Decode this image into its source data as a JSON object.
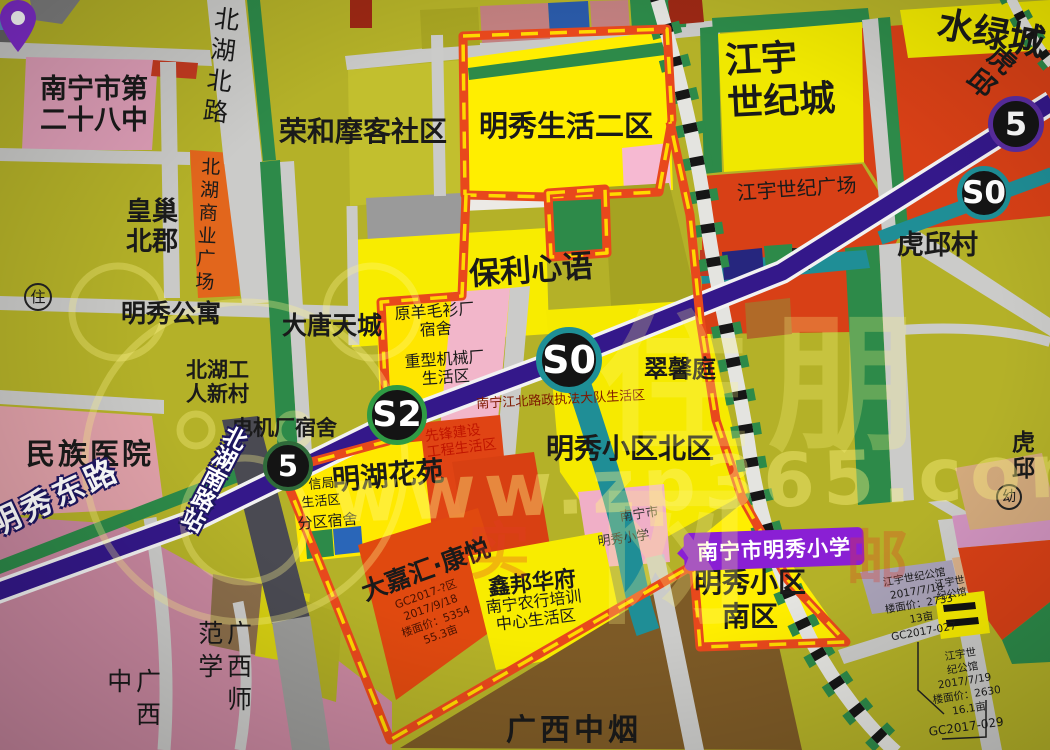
{
  "map": {
    "school_badge": {
      "label": "南宁市明秀小学",
      "bg": "#8a1fd4",
      "text_color": "#ffffff",
      "pin_color": "#7e2cc9"
    },
    "stations": [
      {
        "name": "station-badge-line5-ne",
        "label": "5",
        "cx": 1016,
        "cy": 124,
        "r": 28,
        "ring": "#5a2da0"
      },
      {
        "name": "station-badge-s0-ne",
        "label": "S0",
        "cx": 984,
        "cy": 193,
        "r": 27,
        "ring": "#1e8f96"
      },
      {
        "name": "station-badge-s0-center",
        "label": "S0",
        "cx": 569,
        "cy": 360,
        "r": 33,
        "ring": "#1e8f96"
      },
      {
        "name": "station-badge-s2",
        "label": "S2",
        "cx": 397,
        "cy": 415,
        "r": 30,
        "ring": "#2f9b44"
      },
      {
        "name": "station-badge-line5-west",
        "label": "5",
        "cx": 288,
        "cy": 466,
        "r": 25,
        "ring": "#2f6b3a"
      }
    ],
    "labels": [
      {
        "name": "label-no28-middle-school",
        "text": "南宁市第\n二十八中",
        "x": 40,
        "y": 74,
        "size": 27,
        "bold": true
      },
      {
        "name": "label-road-beihu-north",
        "text": "北湖北路",
        "x": 212,
        "y": 4,
        "size": 25,
        "v": true,
        "rot": 7,
        "ls": 6
      },
      {
        "name": "label-ronghe-moke",
        "text": "荣和摩客社区",
        "x": 279,
        "y": 116,
        "size": 28,
        "bold": true
      },
      {
        "name": "label-mingxiu-life2",
        "text": "明秀生活二区",
        "x": 479,
        "y": 110,
        "size": 29,
        "bold": true
      },
      {
        "name": "label-jiangyu-century-city",
        "text": "江宇\n世纪城",
        "x": 724,
        "y": 40,
        "size": 36,
        "bold": true,
        "rot": -3,
        "lh": 1.2
      },
      {
        "name": "label-shuilv-city",
        "text": "水绿城",
        "x": 942,
        "y": 4,
        "size": 36,
        "bold": true,
        "rot": 11
      },
      {
        "name": "label-jiangyu-plaza",
        "text": "江宇世纪广场",
        "x": 736,
        "y": 182,
        "size": 20,
        "rot": -4
      },
      {
        "name": "label-huqiu-village",
        "text": "虎邱村",
        "x": 897,
        "y": 230,
        "size": 27,
        "bold": true
      },
      {
        "name": "label-huangchao-beijun",
        "text": "皇巢\n北郡",
        "x": 126,
        "y": 198,
        "size": 26,
        "bold": true
      },
      {
        "name": "label-beihu-commercial-plaza",
        "text": "北湖商业广场",
        "x": 198,
        "y": 156,
        "size": 19,
        "v": true,
        "rot": 3,
        "ls": 4
      },
      {
        "name": "icon-zhu-circled",
        "text": "住",
        "x": 24,
        "y": 283,
        "size": 15,
        "circled": true
      },
      {
        "name": "label-mingxiu-apartment",
        "text": "明秀公寓",
        "x": 121,
        "y": 300,
        "size": 25,
        "bold": true
      },
      {
        "name": "label-datang-tiancheng",
        "text": "大唐天城",
        "x": 282,
        "y": 312,
        "size": 25,
        "bold": true
      },
      {
        "name": "label-baoli-xinyu",
        "text": "保利心语",
        "x": 468,
        "y": 258,
        "size": 31,
        "bold": true,
        "rot": -4
      },
      {
        "name": "label-yangmaoshan-dorm",
        "text": "原羊毛衫厂\n宿舍",
        "x": 386,
        "y": 306,
        "size": 16,
        "rot": -4,
        "w": 96,
        "align": "center"
      },
      {
        "name": "label-heavy-machinery",
        "text": "重型机械厂\n生活区",
        "x": 396,
        "y": 354,
        "size": 16,
        "rot": -4,
        "w": 96,
        "align": "center"
      },
      {
        "name": "label-cuixinting",
        "text": "翠馨庭",
        "x": 644,
        "y": 356,
        "size": 24,
        "bold": true
      },
      {
        "name": "label-beihu-workers-village",
        "text": "北湖工\n人新村",
        "x": 186,
        "y": 358,
        "size": 21,
        "bold": true
      },
      {
        "name": "label-dianjichang-dorm",
        "text": "电机厂宿舍",
        "x": 232,
        "y": 416,
        "size": 21,
        "bold": true
      },
      {
        "name": "label-luzheng-shenghuoqu",
        "text": "南宁江北路政执法大队生活区",
        "x": 476,
        "y": 398,
        "size": 13,
        "color": "#7d1800",
        "rot": -3
      },
      {
        "name": "label-xianfeng-jianshe",
        "text": "先锋建设\n工程生活区",
        "x": 424,
        "y": 429,
        "size": 14,
        "color": "#c01500",
        "rot": -7
      },
      {
        "name": "label-mingxiu-north",
        "text": "明秀小区北区",
        "x": 546,
        "y": 433,
        "size": 28,
        "bold": true
      },
      {
        "name": "label-minzu-hospital",
        "text": "民族医院",
        "x": 26,
        "y": 438,
        "size": 29,
        "bold": true,
        "ls": 3
      },
      {
        "name": "label-beihunan-road-station",
        "text": "北湖南路站",
        "x": 226,
        "y": 420,
        "size": 23,
        "v": true,
        "rot": 27,
        "color": "#ffffff",
        "halo": "dark",
        "bold": true
      },
      {
        "name": "label-minghu-huayuan",
        "text": "明湖花苑",
        "x": 331,
        "y": 465,
        "size": 28,
        "bold": true,
        "rot": -5
      },
      {
        "name": "label-xinju",
        "text": "信局",
        "x": 308,
        "y": 479,
        "size": 13,
        "rot": -5
      },
      {
        "name": "label-shenghuoqu",
        "text": "生活区",
        "x": 301,
        "y": 497,
        "size": 13,
        "rot": -5
      },
      {
        "name": "label-fenqu-sushe",
        "text": "分区宿舍",
        "x": 297,
        "y": 516,
        "size": 15,
        "rot": -5
      },
      {
        "name": "label-mingxiu-east-road",
        "text": "明秀东路",
        "x": -16,
        "y": 512,
        "size": 31,
        "color": "#ffffff",
        "halo": "dark",
        "bold": true,
        "rot": -25,
        "ls": 4
      },
      {
        "name": "label-dajiahui-kangyue",
        "text": "大嘉汇·康悦",
        "x": 358,
        "y": 580,
        "size": 25,
        "bold": true,
        "rot": -20
      },
      {
        "name": "label-dajiahui-parcel-info",
        "text": "GC2017-?区\n2017/9/18\n楼面价：5354\n55.3亩",
        "x": 372,
        "y": 607,
        "size": 11,
        "rot": -20,
        "color": "#4a1200",
        "w": 110,
        "align": "center",
        "lh": 1.3
      },
      {
        "name": "label-xinbang-huafu",
        "text": "鑫邦华府",
        "x": 487,
        "y": 576,
        "size": 22,
        "bold": true,
        "rot": -6
      },
      {
        "name": "label-nongHang-training",
        "text": "南宁农行培训\n中心生活区",
        "x": 478,
        "y": 600,
        "size": 16,
        "rot": -7,
        "w": 110,
        "align": "center"
      },
      {
        "name": "label-pin-caption-top",
        "text": "南宁市",
        "x": 619,
        "y": 511,
        "size": 13,
        "rot": -8,
        "color": "#333333"
      },
      {
        "name": "label-pin-caption-bottom",
        "text": "明秀小学",
        "x": 597,
        "y": 536,
        "size": 13,
        "rot": -8,
        "color": "#333333"
      },
      {
        "name": "label-mingxiu-south",
        "text": "明秀小区\n南区",
        "x": 690,
        "y": 566,
        "size": 28,
        "bold": true,
        "w": 120,
        "align": "center",
        "lh": 1.2
      },
      {
        "name": "label-gx-normal-university",
        "text": "广西师范学",
        "x": 194,
        "y": 620,
        "size": 25,
        "v": true,
        "ls": 8
      },
      {
        "name": "label-gx-zhong",
        "text": "广西中",
        "x": 103,
        "y": 668,
        "size": 25,
        "v": true,
        "ls": 8
      },
      {
        "name": "label-gx-zhongyan",
        "text": "广西中烟",
        "x": 506,
        "y": 714,
        "size": 30,
        "bold": true,
        "ls": 4
      },
      {
        "name": "label-jiangyu-gongguan-parcel1",
        "text": "江宇世纪公馆\n2017/7/18\n楼面价：2733\n13亩\nGC2017-027",
        "x": 866,
        "y": 580,
        "size": 10.5,
        "rot": -10,
        "w": 96,
        "align": "center",
        "lh": 1.3
      },
      {
        "name": "label-jiangyu-gongguan-parcel2",
        "text": "江宇世\n纪公馆",
        "x": 934,
        "y": 580,
        "size": 10,
        "rot": -10,
        "lh": 1.2
      },
      {
        "name": "label-jiangyu-gongguan-parcel3",
        "text": "江宇世\n纪公馆\n2017/7/19\n楼面价：2630\n16.1亩",
        "x": 920,
        "y": 655,
        "size": 10.5,
        "rot": -9,
        "w": 80,
        "align": "center",
        "lh": 1.3
      },
      {
        "name": "label-gc2017-029",
        "text": "GC2017-029",
        "x": 928,
        "y": 726,
        "size": 12,
        "rot": -8
      },
      {
        "name": "icon-you-circled",
        "text": "幼",
        "x": 996,
        "y": 484,
        "size": 14,
        "circled": true
      },
      {
        "name": "label-huqiu-partial",
        "text": "虎邱",
        "x": 1012,
        "y": 430,
        "size": 23,
        "bold": true
      },
      {
        "name": "label-huqiu-edge",
        "text": "虎邱",
        "x": 1002,
        "y": 40,
        "size": 27,
        "bold": true,
        "rot": 42
      },
      {
        "name": "watermark-url",
        "text": "www.zp365.com",
        "x": 330,
        "y": 455,
        "size": 74,
        "bold": true,
        "color": "rgba(255,246,130,0.40)",
        "ls": 8,
        "rot": -2,
        "z": 30
      },
      {
        "name": "watermark-site-name",
        "text": "住朋网",
        "x": 598,
        "y": 300,
        "size": 150,
        "bold": true,
        "color": "rgba(255,246,130,0.26)",
        "ls": 20,
        "z": 30
      },
      {
        "name": "watermark-red-char-1",
        "text": "实",
        "x": 468,
        "y": 516,
        "size": 62,
        "bold": true,
        "color": "rgba(225,60,40,0.30)",
        "z": 30
      },
      {
        "name": "watermark-red-char-2",
        "text": "邮",
        "x": 846,
        "y": 524,
        "size": 62,
        "bold": true,
        "color": "rgba(225,60,40,0.30)",
        "z": 30
      }
    ]
  }
}
